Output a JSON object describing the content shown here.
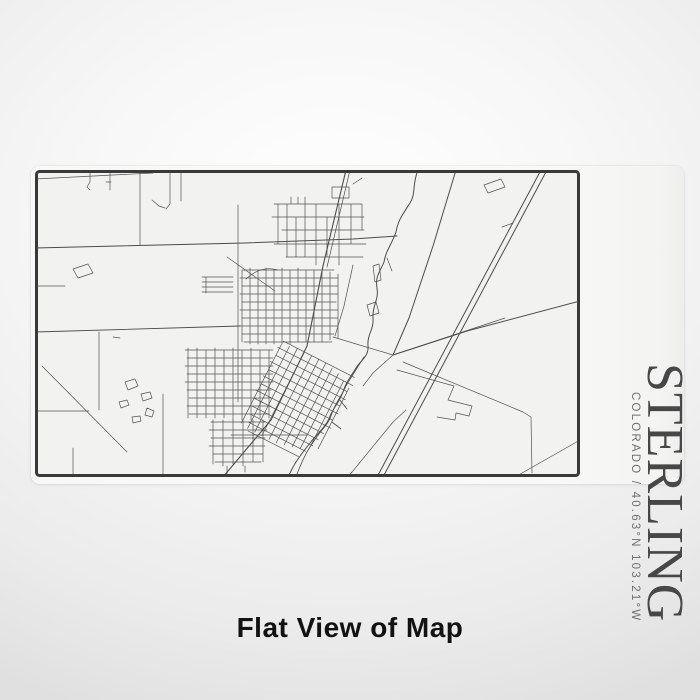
{
  "label": {
    "title": "STERLING",
    "subtitle": "COLORADO / 40.63°N 103.21°W"
  },
  "caption": "Flat View of Map",
  "map": {
    "place_name": "STERLING",
    "region_line": "COLORADO / 40.63°N 103.21°W"
  },
  "colors": {
    "map_border": "#3a3a3a",
    "map_background": "#f2f2f0",
    "road": "#4f4f4f",
    "title_text": "#474747",
    "subtitle_text": "#707070",
    "caption_text": "#121212",
    "card_background": "#f8f8f6"
  }
}
